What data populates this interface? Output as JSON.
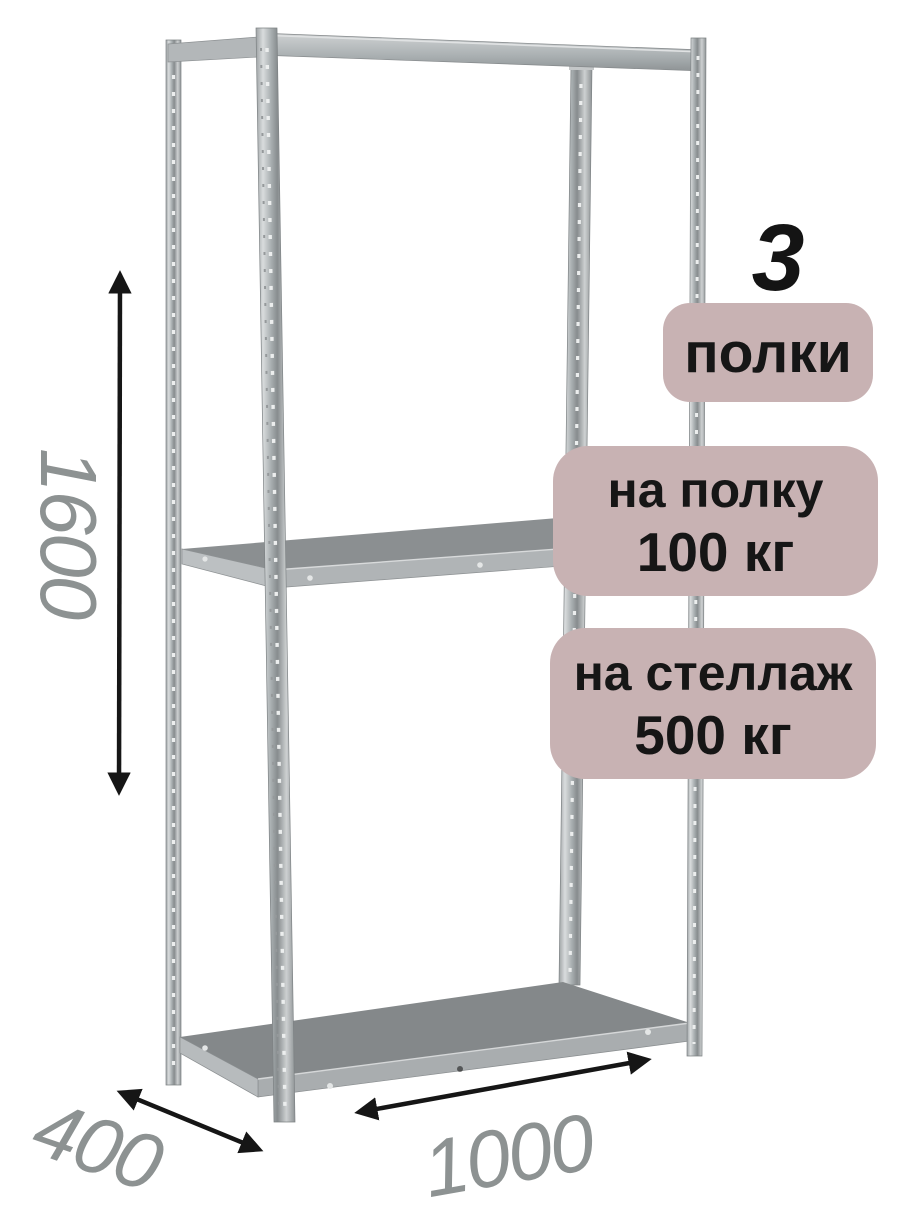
{
  "badges": {
    "count": {
      "value": "3",
      "label": "полки"
    },
    "shelf_load": {
      "line1": "на полку",
      "line2": "100 кг"
    },
    "rack_load": {
      "line1": "на стеллаж",
      "line2": "500 кг"
    }
  },
  "dimensions": {
    "height_mm": "1600",
    "depth_mm": "400",
    "width_mm": "1000"
  },
  "colors": {
    "background": "#ffffff",
    "badge_bg": "#c8b2b3",
    "badge_text": "#161616",
    "dimension_text": "#8d9292",
    "arrow": "#161616",
    "metal_light": "#d9dcdd",
    "metal_mid": "#aab0b2",
    "metal_dark": "#878c8e",
    "shelf_top": "#85898b",
    "shelf_edge": "#aaaeb0"
  }
}
